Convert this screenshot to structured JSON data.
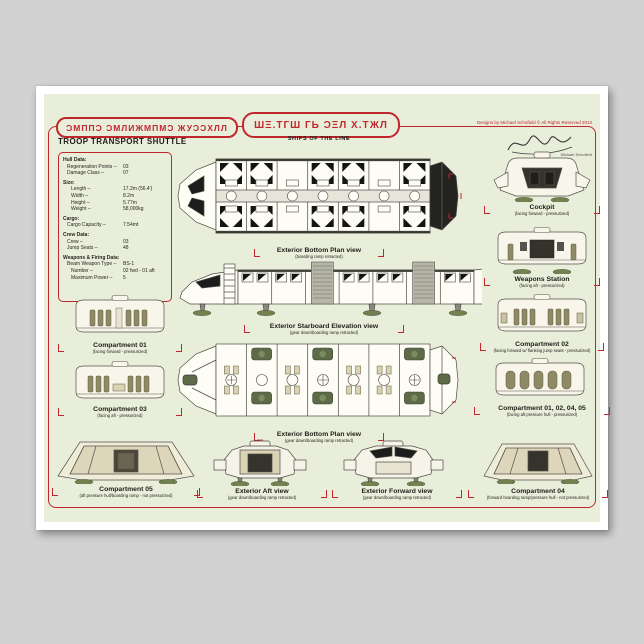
{
  "colors": {
    "canvas_gray": "#d2d2d2",
    "field_green": "#e9eedb",
    "accent_red": "#c0272d",
    "seat_olive": "#8f8a66",
    "gear_green": "#72814f",
    "ink_black": "#1e1e18"
  },
  "header": {
    "alien_title": "ƆМППƆ ƆМЛИЖМПМƆ ЖУƆƆХЛЛ",
    "title": "TROOP TRANSPORT SHUTTLE",
    "alien_series": "ШΞ.ТГШ ГЬ ƆΞЛ Х.ТЖЛ",
    "series_subtitle": "SHIPS OF THE LINE",
    "copyright": "Designs by Michael Schofield © All Rights Reserved 2013",
    "signature_caption": "Michael Schofield"
  },
  "stats": {
    "sections": [
      {
        "title": "Hull Data:",
        "rows": [
          [
            "Regeneration Points –",
            "03"
          ],
          [
            "Damage Class –",
            "07"
          ]
        ]
      },
      {
        "title": "Size:",
        "rows": [
          [
            "Length –",
            "17.2m (56.4')"
          ],
          [
            "Width –",
            "8.2m"
          ],
          [
            "Height –",
            "5.77m"
          ],
          [
            "Weight –",
            "58,000kg"
          ]
        ]
      },
      {
        "title": "Cargo:",
        "rows": [
          [
            "Cargo Capacity –",
            "7.54mt"
          ]
        ]
      },
      {
        "title": "Crew Data:",
        "rows": [
          [
            "Crew –",
            "03"
          ],
          [
            "Jump Seats –",
            "48"
          ]
        ]
      },
      {
        "title": "Weapons & Firing Data:",
        "rows": [
          [
            "Beam Weapon Type –",
            "BS-1"
          ],
          [
            "Number –",
            "02 fwd - 01 aft"
          ],
          [
            "Maximum Power –",
            "5"
          ]
        ]
      }
    ]
  },
  "views": {
    "plan_top": {
      "title": "Exterior Bottom Plan view",
      "note": "(boarding ramp retracted)"
    },
    "elevation": {
      "title": "Exterior Starboard Elevation view",
      "note": "(gear down/boarding ramp retracted)"
    },
    "plan_gear": {
      "title": "Exterior Bottom Plan view",
      "note": "(gear down/boarding ramp retracted)"
    },
    "aft": {
      "title": "Exterior Aft view",
      "note": "(gear down/boarding ramp retracted)"
    },
    "forward": {
      "title": "Exterior Forward view",
      "note": "(gear down/boarding ramp retracted)"
    },
    "cockpit": {
      "title": "Cockpit",
      "note": "(facing forward - pressurized)"
    },
    "weapons": {
      "title": "Weapons Station",
      "note": "(facing aft - pressurized)"
    },
    "comp01": {
      "title": "Compartment 01",
      "note": "(facing forward - pressurized)"
    },
    "comp02": {
      "title": "Compartment 02",
      "note": "(facing forward w/ flanking jump seats - pressurized)"
    },
    "comp03": {
      "title": "Compartment 03",
      "note": "(facing aft - pressurized)"
    },
    "comp_group": {
      "title": "Compartment 01, 02, 04, 05",
      "note": "(facing aft pressure hull - pressurized)"
    },
    "comp04": {
      "title": "Compartment 04",
      "note": "(forward boarding ramp/pressure hull - not pressurized)"
    },
    "comp05": {
      "title": "Compartment 05",
      "note": "(aft pressure hull/boarding ramp - not pressurized)"
    }
  }
}
